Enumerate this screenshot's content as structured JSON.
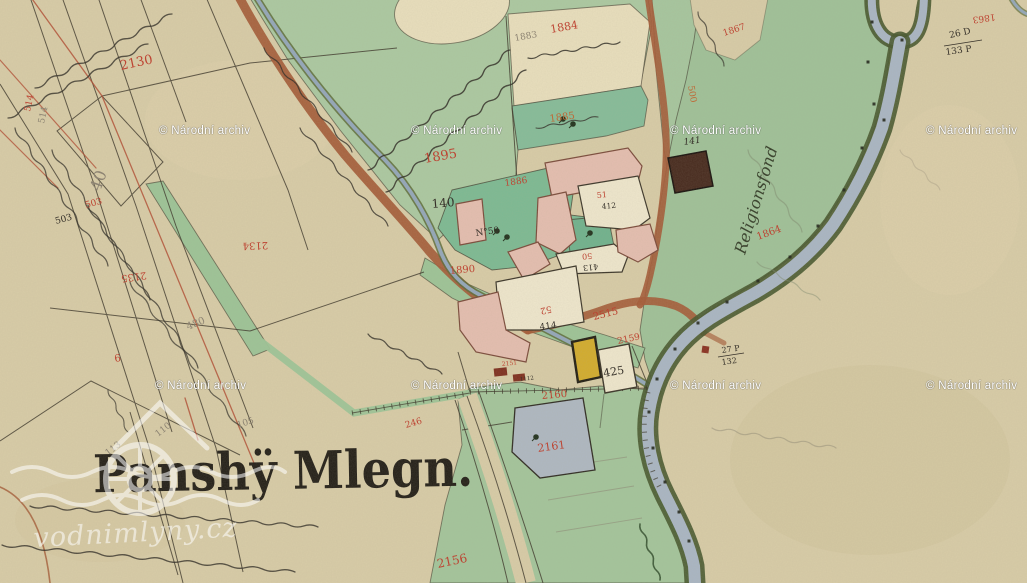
{
  "map": {
    "title": "Panshÿ Mlegn.",
    "watermark": {
      "archive": "© Národní archiv",
      "positions": [
        [
          159,
          134
        ],
        [
          411,
          134
        ],
        [
          670,
          134
        ],
        [
          926,
          134
        ],
        [
          155,
          389
        ],
        [
          411,
          389
        ],
        [
          670,
          389
        ],
        [
          926,
          389
        ]
      ],
      "logo_text": "vodnimlyny.cz"
    },
    "palette": {
      "parchment": "#d8cca7",
      "meadow": "#a6c69e",
      "garden": "#7cba93",
      "water": "#a9b6c4",
      "bank": "#46572e",
      "road": "#a45a36",
      "building_pink": "#e5beb0",
      "building_dark": "#46291d",
      "building_yellow": "#d3ac2c",
      "pond": "#aeb8c2",
      "ink_red": "#bf3b2a",
      "ink_red_light": "#c0632e",
      "ink_black": "#2b2620",
      "pencil": "#8a8070",
      "ink_green": "#333d28"
    },
    "labels": [
      {
        "t": "2130",
        "x": 121,
        "y": 70,
        "c": "red",
        "s": 13,
        "r": -12
      },
      {
        "t": "514",
        "x": 30,
        "y": 112,
        "c": "red",
        "s": 9,
        "r": -78
      },
      {
        "t": "514",
        "x": 44,
        "y": 124,
        "c": "gray",
        "s": 9,
        "r": -78
      },
      {
        "t": "503",
        "x": 86,
        "y": 208,
        "c": "red",
        "s": 9,
        "r": -15
      },
      {
        "t": "503",
        "x": 56,
        "y": 224,
        "c": "black",
        "s": 9,
        "r": -15
      },
      {
        "t": "40",
        "x": 100,
        "y": 192,
        "c": "gray",
        "s": 16,
        "r": -70
      },
      {
        "t": "2134",
        "x": 268,
        "y": 242,
        "c": "red",
        "s": 10,
        "r": 178
      },
      {
        "t": "2135",
        "x": 146,
        "y": 272,
        "c": "red",
        "s": 10,
        "r": 172
      },
      {
        "t": "480",
        "x": 188,
        "y": 330,
        "c": "gray",
        "s": 10,
        "r": -22
      },
      {
        "t": "6",
        "x": 115,
        "y": 362,
        "c": "red",
        "s": 10,
        "r": -10
      },
      {
        "t": "105",
        "x": 238,
        "y": 428,
        "c": "gray",
        "s": 9,
        "r": -18
      },
      {
        "t": "110",
        "x": 158,
        "y": 437,
        "c": "gray",
        "s": 9,
        "r": -38
      },
      {
        "t": "113",
        "x": 108,
        "y": 456,
        "c": "gray",
        "s": 9,
        "r": -38
      },
      {
        "t": "246",
        "x": 406,
        "y": 428,
        "c": "red",
        "s": 9,
        "r": -16
      },
      {
        "t": "2156",
        "x": 438,
        "y": 568,
        "c": "red",
        "s": 12,
        "r": -12
      },
      {
        "t": "1883",
        "x": 515,
        "y": 41,
        "c": "gray",
        "s": 9,
        "r": -10
      },
      {
        "t": "1884",
        "x": 551,
        "y": 33,
        "c": "red",
        "s": 11,
        "r": -10
      },
      {
        "t": "1885",
        "x": 550,
        "y": 122,
        "c": "red2",
        "s": 10,
        "r": -8
      },
      {
        "t": "1895",
        "x": 425,
        "y": 163,
        "c": "red",
        "s": 13,
        "r": -10
      },
      {
        "t": "1886",
        "x": 505,
        "y": 186,
        "c": "red",
        "s": 9,
        "r": -8
      },
      {
        "t": "140",
        "x": 432,
        "y": 208,
        "c": "black",
        "s": 12,
        "r": -5
      },
      {
        "t": "N°50",
        "x": 476,
        "y": 236,
        "c": "black",
        "s": 9,
        "r": -8
      },
      {
        "t": "1890",
        "x": 450,
        "y": 274,
        "c": "red",
        "s": 10,
        "r": -5
      },
      {
        "t": "141",
        "x": 684,
        "y": 145,
        "c": "black",
        "s": 9,
        "r": -8,
        "i": 1
      },
      {
        "t": "51",
        "x": 597,
        "y": 198,
        "c": "red",
        "s": 8,
        "r": -5
      },
      {
        "t": "412",
        "x": 602,
        "y": 209,
        "c": "black",
        "s": 7.5,
        "r": -5
      },
      {
        "t": "50",
        "x": 592,
        "y": 253,
        "c": "red",
        "s": 8,
        "r": 175
      },
      {
        "t": "413",
        "x": 598,
        "y": 264,
        "c": "black",
        "s": 8,
        "r": 175
      },
      {
        "t": "52",
        "x": 551,
        "y": 306,
        "c": "red",
        "s": 9,
        "r": 168
      },
      {
        "t": "414",
        "x": 540,
        "y": 330,
        "c": "black",
        "s": 9,
        "r": -8
      },
      {
        "t": "425",
        "x": 604,
        "y": 377,
        "c": "black",
        "s": 11,
        "r": -10
      },
      {
        "t": "2515",
        "x": 594,
        "y": 320,
        "c": "red",
        "s": 10,
        "r": -14
      },
      {
        "t": "2159",
        "x": 618,
        "y": 344,
        "c": "red",
        "s": 9,
        "r": -12
      },
      {
        "t": "2151",
        "x": 502,
        "y": 366,
        "c": "red",
        "s": 6,
        "r": -6
      },
      {
        "t": "1112",
        "x": 520,
        "y": 381,
        "c": "black",
        "s": 5.5,
        "r": -6
      },
      {
        "t": "2160",
        "x": 542,
        "y": 399,
        "c": "red",
        "s": 10,
        "r": -5
      },
      {
        "t": "2161",
        "x": 538,
        "y": 452,
        "c": "red",
        "s": 11,
        "r": -8
      },
      {
        "t": "1864",
        "x": 758,
        "y": 240,
        "c": "red",
        "s": 10,
        "r": -20
      },
      {
        "t": "1867",
        "x": 724,
        "y": 36,
        "c": "red",
        "s": 9,
        "r": -18
      },
      {
        "t": "1863",
        "x": 995,
        "y": 14,
        "c": "red",
        "s": 9,
        "r": 172
      },
      {
        "t": "500",
        "x": 688,
        "y": 86,
        "c": "red2",
        "s": 9,
        "r": 80
      },
      {
        "t": "26 D",
        "x": 950,
        "y": 38,
        "c": "black",
        "s": 9,
        "r": -12
      },
      {
        "t": "133 P",
        "x": 946,
        "y": 55,
        "c": "black",
        "s": 9,
        "r": -8
      },
      {
        "t": "27 P",
        "x": 722,
        "y": 353,
        "c": "black",
        "s": 8,
        "r": -8
      },
      {
        "t": "132",
        "x": 722,
        "y": 365,
        "c": "black",
        "s": 8,
        "r": -8
      },
      {
        "t": "Religionsfond",
        "x": 745,
        "y": 255,
        "c": "green",
        "s": 16,
        "r": -73,
        "i": 1
      }
    ]
  }
}
